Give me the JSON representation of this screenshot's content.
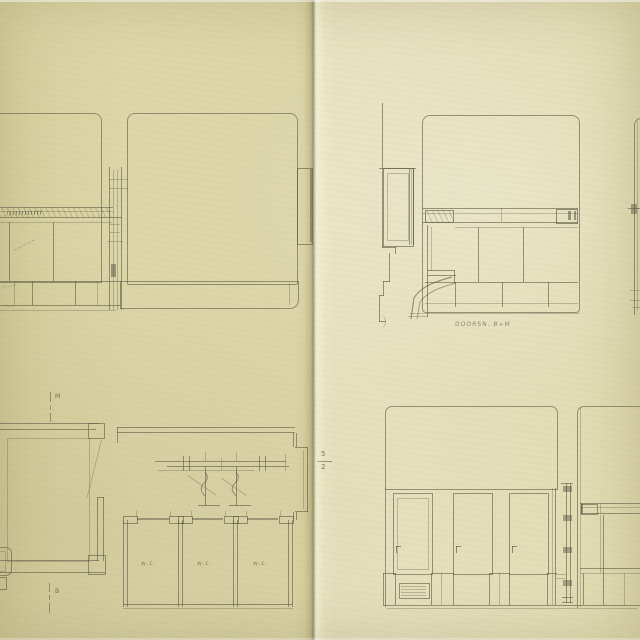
{
  "captions": {
    "top_right_caption": "DOORSN. B+M",
    "sheet_number_top": "5",
    "sheet_number_bottom": "2"
  },
  "plan": {
    "marker_top": "M",
    "marker_bottom": "B",
    "wc_labels": [
      "w.c.",
      "w.c.",
      "w.c."
    ]
  },
  "annotations": {
    "panel_note": "~~~~~",
    "skirting_note": "~~~",
    "footer_note": "~~"
  },
  "colors": {
    "paper_left": "#dcd6a8",
    "paper_right": "#e3deba",
    "ink": "#615e46",
    "pencil": "#5a553c"
  }
}
